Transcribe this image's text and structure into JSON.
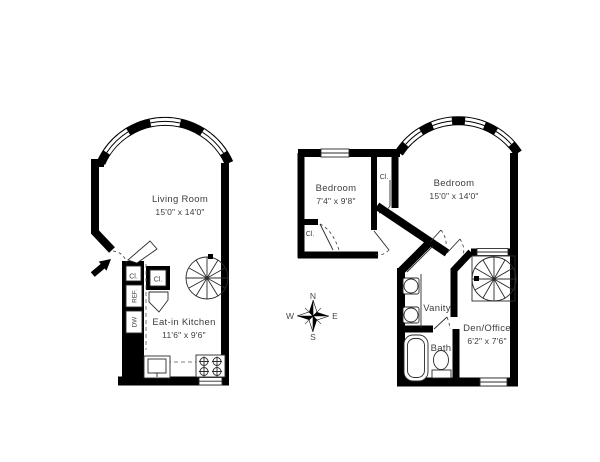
{
  "canvas": {
    "background": "#ffffff",
    "wall_color": "#000000",
    "text_color": "#3d3d3d"
  },
  "floor1": {
    "living_room_label": "Living Room",
    "living_room_dims": "15'0\" x 14'0\"",
    "kitchen_label": "Eat-in Kitchen",
    "kitchen_dims": "11'6\" x 9'6\"",
    "closet_a_label": "Cl.",
    "closet_b_label": "Cl.",
    "fridge_label": "REF.",
    "dishwasher_label": "DW"
  },
  "floor2": {
    "bedroom_small_label": "Bedroom",
    "bedroom_small_dims": "7'4\" x 9'8\"",
    "bedroom_large_label": "Bedroom",
    "bedroom_large_dims": "15'0\" x 14'0\"",
    "closet_small_label": "Cl.",
    "closet_mid_label": "Cl.",
    "vanity_label": "Vanity",
    "bath_label": "Bath",
    "den_label": "Den/Office",
    "den_dims": "6'2\" x 7'6\""
  },
  "compass": {
    "north": "N",
    "east": "E",
    "south": "S",
    "west": "W"
  }
}
